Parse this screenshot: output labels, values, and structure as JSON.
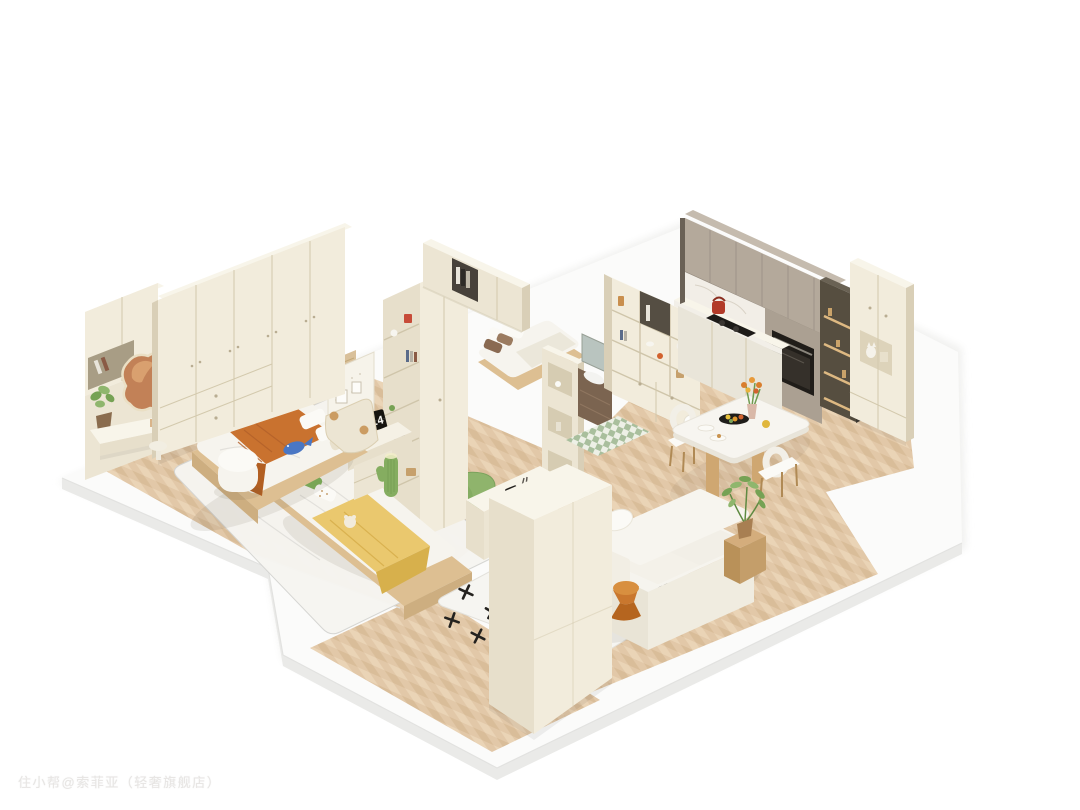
{
  "watermark": {
    "text": "住小帮@索菲亚（轻奢旗舰店）"
  },
  "flip_clock": {
    "hour": "2",
    "minute": "14"
  },
  "palette": {
    "bg": "#ffffff",
    "watermark_color": "#e7e5e3",
    "plinth": "#fbfbfa",
    "plinth_side": "#eaeae8",
    "plinth_edge": "#e2e2e0",
    "wood": "#e2c8a8",
    "wood_light": "#ead4b6",
    "wood_dark": "#d7bb97",
    "cream": "#ece5d3",
    "cream_bright": "#f2ecdc",
    "cream_mid": "#e7dfcb",
    "cream_dark": "#d9cfb7",
    "cream_top": "#f8f5ea",
    "seam": "#d3c9ad",
    "bedding": "#f6f4ee",
    "bedding_bright": "#fbfaf6",
    "bedding_shadow": "#e9e4d6",
    "pillow_green": "#7db05a",
    "throw_orange": "#c9722f",
    "throw_orange_dark": "#b25f22",
    "throw_yellow": "#eac86e",
    "throw_yellow_dark": "#d7b04c",
    "plush_blue": "#4a77c4",
    "knob": "#cb9c62",
    "wood_furn": "#cfa771",
    "wood_furn_dark": "#b08a55",
    "wood_furn_light": "#ddbf92",
    "taupe": "#b4a99b",
    "taupe_dark": "#a99e90",
    "marble": "#f2eee7",
    "black": "#201d19",
    "pantry": "#564e40",
    "pantry_glow": "#e6bf86",
    "plant": "#76a254",
    "plant_light": "#8fb66d",
    "rug_white": "#f6f5f1",
    "rug_line": "#d2d3d0",
    "rug_green": "#8fb46c",
    "rug_green_dark": "#7ba25c",
    "mark": "#24221f",
    "tile_green": "#a9bf9d",
    "tile_white": "#edf0e6",
    "vanity_wood": "#7b6450",
    "mirror_warm": "#c28157",
    "mirror_high": "#d9a06f",
    "shadow": "rgba(90,75,55,0.10)",
    "shade": "rgba(0,0,0,0.06)"
  }
}
